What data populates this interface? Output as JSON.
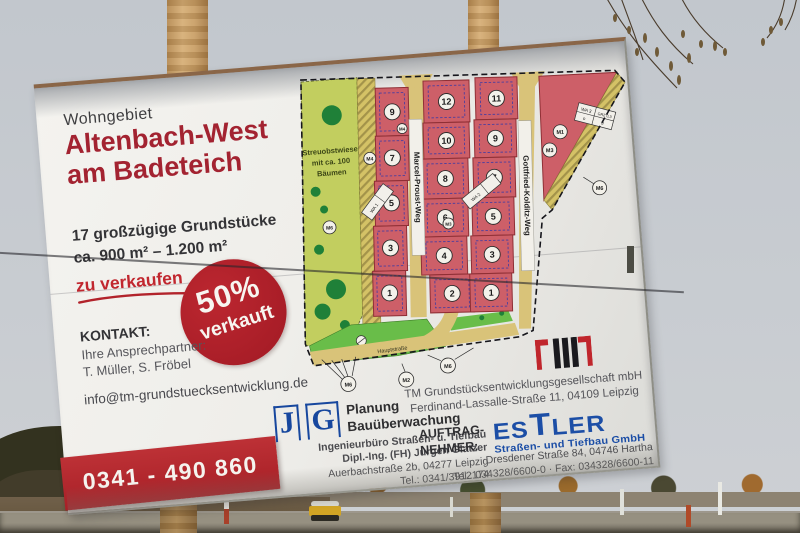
{
  "sign": {
    "kicker": "Wohngebiet",
    "title_line1": "Altenbach-West",
    "title_line2": "am Badeteich",
    "offer_line1": "17 großzügige Grundstücke",
    "offer_line2": "ca. 900 m² – 1.200 m²",
    "cta": "zu verkaufen",
    "badge": {
      "percent": "50%",
      "word": "verkauft"
    },
    "contact": {
      "heading": "KONTAKT:",
      "intro": "Ihre Ansprechpartner:",
      "names": "T. Müller, S. Fröbel",
      "email": "info@tm-grundstuecksentwicklung.de"
    },
    "phone": "0341 - 490 860"
  },
  "map": {
    "meadow": [
      "Streuobstwiese",
      "mit ca. 100",
      "Bäumen"
    ],
    "streets": {
      "marcel": "Marcel-Proust-Weg",
      "gottfried": "Gottfried-Kolditz-Weg",
      "haupt": "Hauptstraße"
    },
    "lots": {
      "left": [
        "9",
        "7",
        "5",
        "3",
        "1"
      ],
      "middle": [
        "12",
        "10",
        "8",
        "6",
        "4",
        "2"
      ],
      "right": [
        "11",
        "9",
        "7",
        "5",
        "3",
        "1"
      ]
    },
    "markers": {
      "m1": "M1",
      "m2": "M2",
      "m3": "M3",
      "m4": "M4",
      "m6": "M6"
    },
    "tables": {
      "wa1": "WA 1",
      "wa2": "WA 2",
      "wa3": "WA 3",
      "grz": "GRZ 0,3",
      "circle": "o",
      "floors": "II"
    }
  },
  "developer": {
    "company": "TM Grundstücksentwicklungsgesellschaft mbH",
    "address": "Ferdinand-Lassalle-Straße 11, 04109 Leipzig"
  },
  "planner": {
    "logo_j": "J",
    "logo_g": "G",
    "name_line1": "Planung",
    "name_line2": "Bauüberwachung",
    "addr1": "Ingenieurbüro Straßen- u. Tiefbau",
    "addr2": "Dipl.-Ing. (FH) Jürgen Glatzer",
    "addr3": "Auerbachstraße 2b, 04277 Leipzig",
    "addr4": "Tel.: 0341/3912174"
  },
  "contractor": {
    "label1": "AUFTRAG-",
    "label2": "NEHMER:",
    "logo_pre": "ES",
    "logo_t": "T",
    "logo_post": "LER",
    "logo_sub": "Straßen- und Tiefbau GmbH",
    "addr": "Dresdener Straße 84, 04746 Hartha",
    "tel": "Tel.: 034328/6600-0 · Fax: 034328/6600-11"
  },
  "palette": {
    "title_red": "#a32331",
    "badge_red": "#a81f27",
    "bar_red": "#a81f26",
    "logo_blue": "#17479e",
    "estler_blue": "#1c4ea6",
    "lot_pink": "#cd5f68",
    "meadow_green": "#c2ce5f",
    "road_tan": "#d9c379",
    "grass_green": "#69bd49",
    "tree_green": "#1f8038"
  }
}
